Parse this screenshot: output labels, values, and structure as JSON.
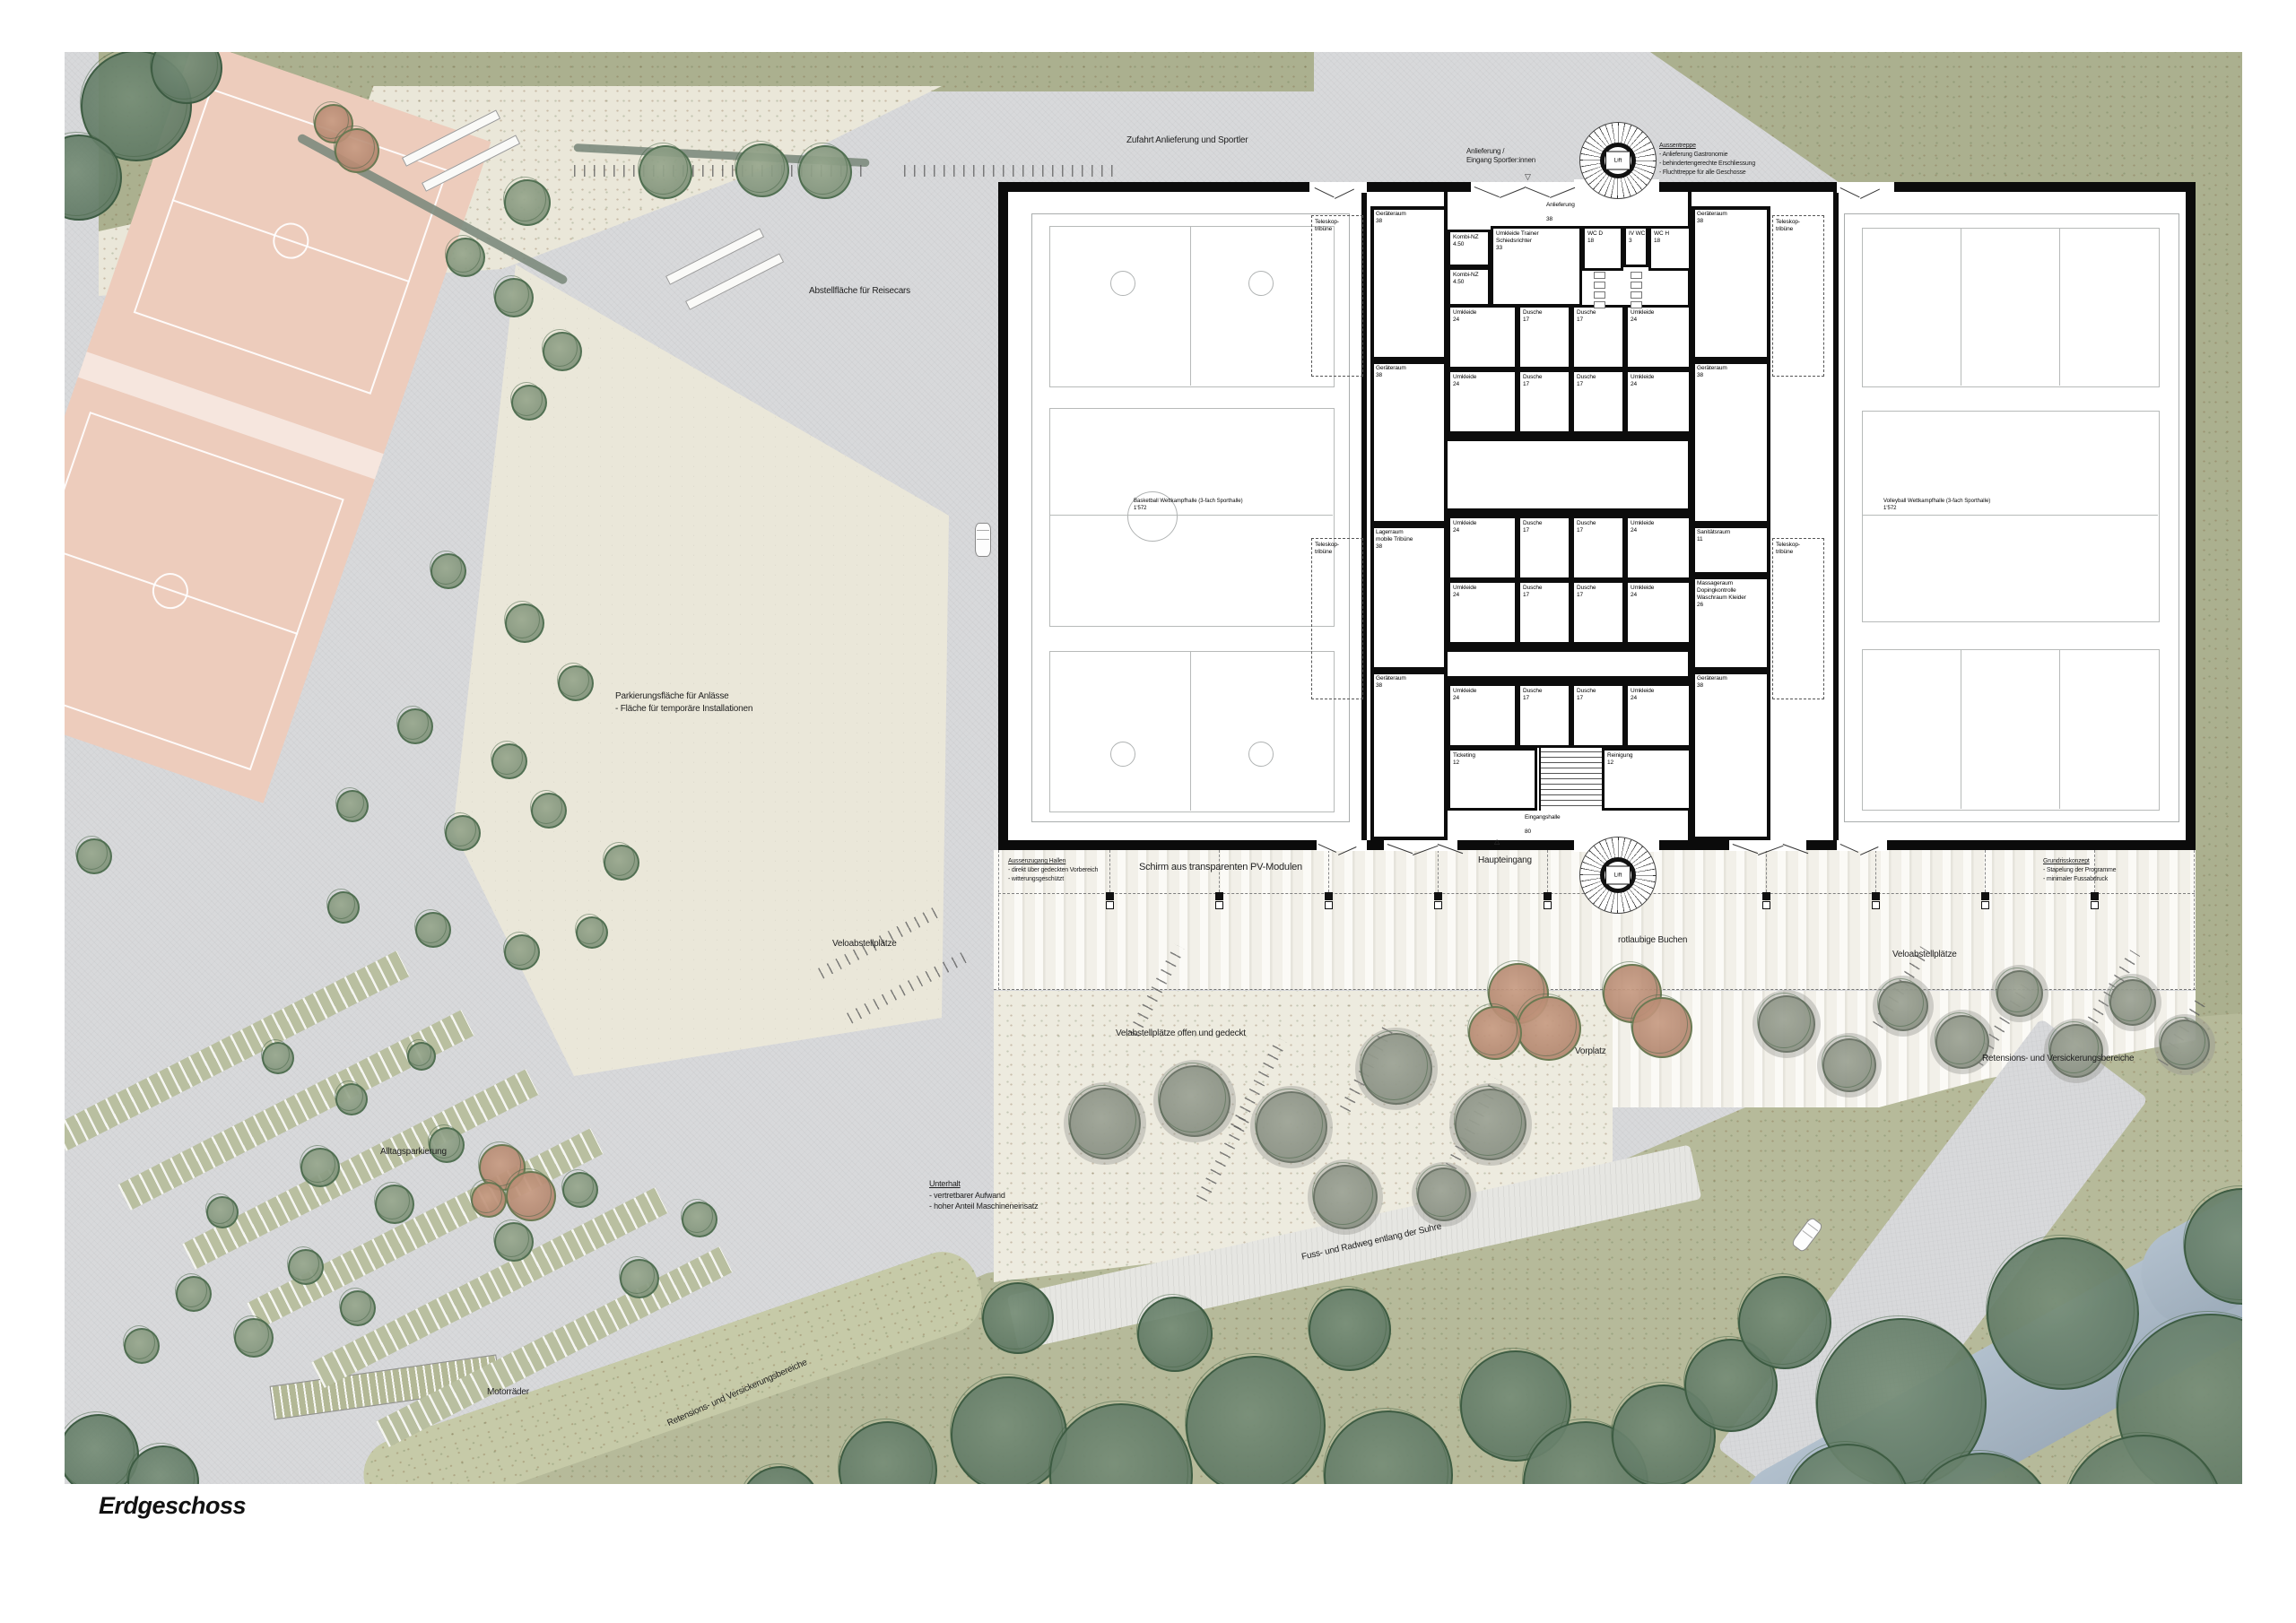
{
  "page_title": "Erdgeschoss",
  "site": {
    "zufahrt": "Zufahrt Anlieferung und Sportler",
    "anlieferung_eingang": [
      "Anlieferung /",
      "Eingang Sportler:innen"
    ],
    "aussentreppe_title": "Aussentreppe",
    "aussentreppe_items": [
      "- Anlieferung Gastronomie",
      "- behindertengerechte Erschliessung",
      "- Fluchttreppe für alle Geschosse"
    ],
    "abstellflaeche": "Abstellfläche für Reisecars",
    "parkierung": [
      "Parkierungsfläche für Anlässe",
      "- Fläche für temporäre Installationen"
    ],
    "velo_links": "Veloabstellplätze",
    "aussenzugang_title": "Aussenzugang Hallen",
    "aussenzugang_items": [
      "- direkt über gedeckten Vorbereich",
      "- witterungsgeschützt"
    ],
    "schirm": "Schirm aus transparenten PV-Modulen",
    "haupteingang": "Haupteingang",
    "grundriss_title": "Grundrisskonzept",
    "grundriss_items": [
      "- Stapelung der Programme",
      "- minimaler Fussabdruck"
    ],
    "velo_offen": "Velabstellplätze offen und gedeckt",
    "vorplatz": "Vorplatz",
    "buchen": "rotlaubige Buchen",
    "velo_rechts": "Veloabstellplätze",
    "retension_rechts": "Retensions- und Versickerungsbereiche",
    "alltagsparkierung": "Alltagsparkierung",
    "unterhalt_title": "Unterhalt",
    "unterhalt_items": [
      "- vertretbarer Aufwand",
      "- hoher Anteil Maschineneinsatz"
    ],
    "fussweg": "Fuss- und Radweg entlang der Suhre",
    "retension_links": "Retensions- und Versickerungsbereiche",
    "motorraeder": "Motorräder"
  },
  "building": {
    "lift": "Lift",
    "halls": {
      "links": {
        "name": "Basketball Wettkampfhalle (3-fach Sporthalle)",
        "area": "1'572"
      },
      "rechts": {
        "name": "Volleyball Wettkampfhalle (3-fach Sporthalle)",
        "area": "1'572"
      }
    },
    "rooms": {
      "anlieferung": {
        "name": "Anlieferung",
        "area": "38"
      },
      "kombi": {
        "name": "Kombi-NZ",
        "area": "4.50"
      },
      "trainer": {
        "name": "Umkleide Trainer\nSchiedsrichter",
        "area": "33"
      },
      "wc_d": {
        "name": "WC D",
        "area": "18"
      },
      "iv_wc": {
        "name": "IV WC",
        "area": "3"
      },
      "wc_h": {
        "name": "WC H",
        "area": "18"
      },
      "geraeteraum": {
        "name": "Geräteraum",
        "area": "38"
      },
      "teleskop": {
        "name": "Teleskop-\ntribüne",
        "area": ""
      },
      "lagerraum": {
        "name": "Lagerraum\nmobile Tribüne",
        "area": "38"
      },
      "sanitaet": {
        "name": "Sanitätsraum",
        "area": "11"
      },
      "massage": {
        "name": "Massageraum\nDopingkontrolle\nWaschraum Kleider",
        "area": "26"
      },
      "umkleide": {
        "name": "Umkleide",
        "area": "24"
      },
      "dusche": {
        "name": "Dusche",
        "area": "17"
      },
      "ticketing": {
        "name": "Ticketing",
        "area": "12"
      },
      "reinigung": {
        "name": "Reinigung",
        "area": "12"
      },
      "eingangshalle": {
        "name": "Eingangshalle",
        "area": "80"
      }
    }
  },
  "colors": {
    "asphalt": "#d8d9db",
    "gravel": "#eae7d9",
    "grass": "#abb08f",
    "field_pink": "#edccbc",
    "river": "#a7b7c6",
    "wall": "#0b0b0b",
    "tree_green": "#7d9479",
    "tree_brown": "#b88f78"
  }
}
